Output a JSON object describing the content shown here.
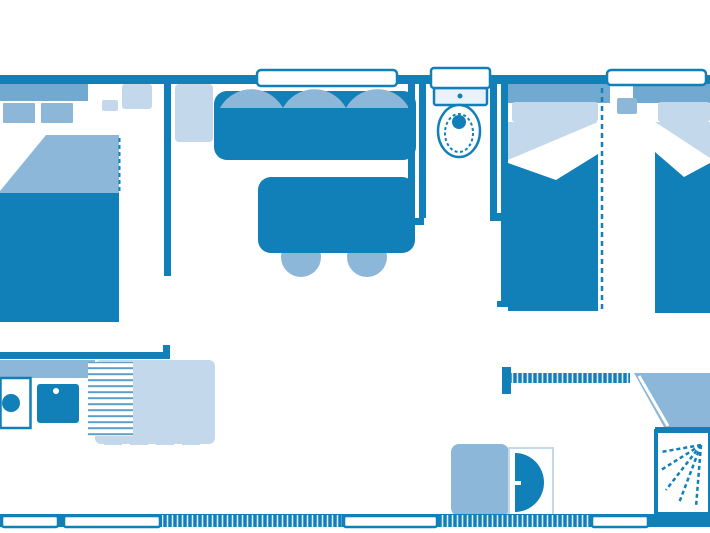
{
  "title": "Mobile home floor plan",
  "colors": {
    "primary": "#1180B8",
    "medium": "#8CB7D8",
    "mediumDark": "#72A9D0",
    "light": "#C3D9EB",
    "pale": "#E9F2F9"
  },
  "rooms": [
    {
      "id": "master-bedroom",
      "furniture": [
        "double-bed",
        "pillows",
        "blanket-fold",
        "head-shelf",
        "wardrobe"
      ]
    },
    {
      "id": "living-dining-area",
      "furniture": [
        "sofa-bench",
        "seat-cushions",
        "dining-table",
        "stool",
        "stool",
        "cupboard"
      ]
    },
    {
      "id": "wc",
      "furniture": [
        "toilet-cistern",
        "toilet-bowl"
      ]
    },
    {
      "id": "twin-bedroom",
      "furniture": [
        "single-bed-left",
        "single-bed-right",
        "pillows",
        "head-shelf",
        "removable-partition"
      ]
    },
    {
      "id": "bathroom",
      "furniture": [
        "vanity-cabinet",
        "washbasin",
        "corner-unit",
        "shower"
      ]
    },
    {
      "id": "kitchen",
      "furniture": [
        "worktop",
        "sink",
        "hob",
        "draining-board"
      ]
    }
  ],
  "openings": {
    "top_windows": 3,
    "bottom_windows": 4,
    "sliding_doors": 2
  }
}
